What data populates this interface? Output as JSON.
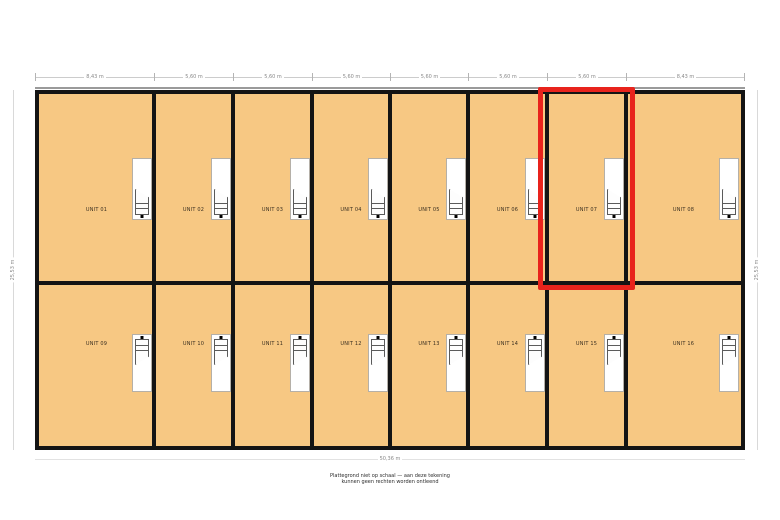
{
  "plan": {
    "top_dimensions": [
      "8,43 m",
      "5,60 m",
      "5,60 m",
      "5,60 m",
      "5,60 m",
      "5,60 m",
      "5,60 m",
      "8,43 m"
    ],
    "bottom_dimension": "50,36 m",
    "left_dimension": "25,53 m",
    "right_dimension": "25,53 m",
    "rows": [
      {
        "units": [
          {
            "label": "UNIT 01"
          },
          {
            "label": "UNIT 02"
          },
          {
            "label": "UNIT 03"
          },
          {
            "label": "UNIT 04"
          },
          {
            "label": "UNIT 05"
          },
          {
            "label": "UNIT 06"
          },
          {
            "label": "UNIT 07"
          },
          {
            "label": "UNIT 08"
          }
        ]
      },
      {
        "units": [
          {
            "label": "UNIT 09"
          },
          {
            "label": "UNIT 10"
          },
          {
            "label": "UNIT 11"
          },
          {
            "label": "UNIT 12"
          },
          {
            "label": "UNIT 13"
          },
          {
            "label": "UNIT 14"
          },
          {
            "label": "UNIT 15"
          },
          {
            "label": "UNIT 16"
          }
        ]
      }
    ],
    "highlight": {
      "unit": "UNIT 07",
      "color": "#E8231C"
    },
    "colors": {
      "unit_fill": "#F7C883",
      "wall": "#141414"
    },
    "footnote": {
      "line1": "Plattegrond niet op schaal — aan deze tekening",
      "line2": "kunnen geen rechten worden ontleend"
    }
  }
}
